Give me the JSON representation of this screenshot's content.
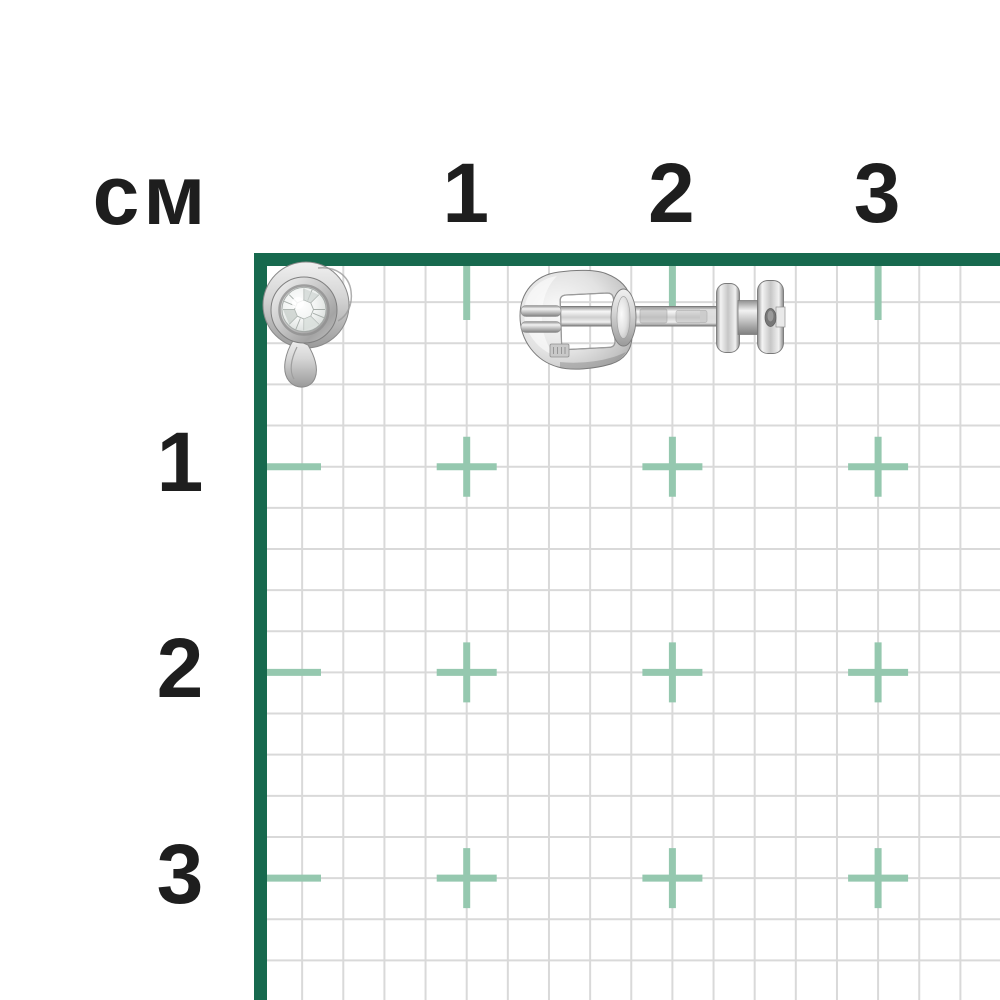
{
  "ruler": {
    "unit_label": "см",
    "top_tick_labels": [
      "1",
      "2",
      "3"
    ],
    "left_tick_labels": [
      "1",
      "2",
      "3"
    ]
  },
  "grid": {
    "origin_x": 261,
    "origin_y": 261,
    "minor_cell_px": 41.14,
    "cm_px": 205.7,
    "canvas_px": 1000,
    "border_outer_x": 254,
    "border_outer_y": 253,
    "border_thickness_px": 13,
    "minor_line_px": 2,
    "tick_len_px": 54,
    "tick_thickness_px": 7,
    "cross_arm_px": 60,
    "cross_count": 3,
    "colors": {
      "minor_line": "#d9d9d9",
      "border": "#17694e",
      "tick": "#95c8af",
      "label": "#1e1e1e",
      "background": "#ffffff"
    }
  },
  "figures": [
    {
      "id": "earring-stud-front",
      "label": "stud-earring-front-view"
    },
    {
      "id": "earring-back-side",
      "label": "stud-earring-side-view-with-screw-clutch"
    }
  ]
}
